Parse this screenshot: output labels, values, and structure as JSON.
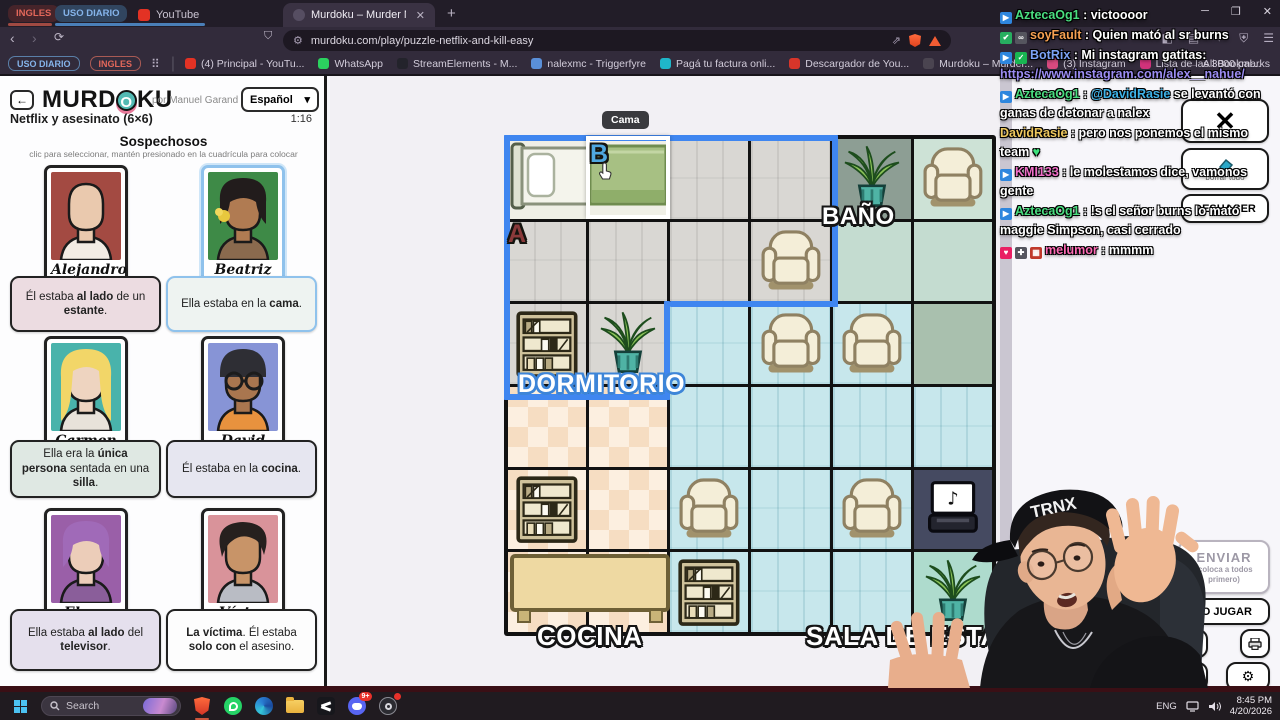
{
  "browser": {
    "tab_groups": [
      {
        "label": "INGLES"
      },
      {
        "label": "USO DIARIO"
      }
    ],
    "youtube_tab": "YouTube",
    "active_tab": "Murdoku – Murder Mystery mee",
    "close_glyph": "✕",
    "new_tab": "+",
    "url": "murdoku.com/play/puzzle-netflix-and-kill-easy",
    "bookmark_pills": [
      "USO DIARIO",
      "INGLES"
    ],
    "bookmarks": [
      {
        "label": "(4) Principal - YouTu...",
        "color": "#e33224"
      },
      {
        "label": "WhatsApp",
        "color": "#2bd25f"
      },
      {
        "label": "StreamElements - M...",
        "color": "#23232b"
      },
      {
        "label": "nalexmc - Triggerfyre",
        "color": "#5a8fd8"
      },
      {
        "label": "Pagá tu factura onli...",
        "color": "#1fb6c9"
      },
      {
        "label": "Descargador de You...",
        "color": "#d8352a"
      },
      {
        "label": "Murdoku – Murder...",
        "color": "#4a4450"
      },
      {
        "label": "(3) Instagram",
        "color": "#d84a7f"
      },
      {
        "label": "Lista de las 3000 pal...",
        "color": "#d0327a"
      }
    ],
    "all_bookmarks": "All Bookmarks",
    "window_controls": [
      "─",
      "❐",
      "✕"
    ]
  },
  "game": {
    "logo_pre": "MURD",
    "logo_o": "O",
    "logo_post": "KU",
    "back_glyph": "←",
    "byline": "por Manuel Garand",
    "language": "Español",
    "lang_chevron": "▾",
    "puzzle_title": "Netflix y asesinato (6×6)",
    "timer": "1:16",
    "suspects_heading": "Sospechosos",
    "suspects_hint": "clic para seleccionar, mantén presionado en la cuadrícula para colocar",
    "suspects": [
      {
        "name": "Alejandro",
        "selected": false,
        "avatar": {
          "bg": "#a34a42",
          "skin": "#eac9ae",
          "hair": "none",
          "hairColor": "#caa88e",
          "shirt": "#f2ece4",
          "accessory": "none"
        },
        "clue": [
          [
            "Él estaba ",
            0
          ],
          [
            "al lado",
            1
          ],
          [
            " de un ",
            0
          ],
          [
            "estante",
            1
          ],
          [
            ".",
            0
          ]
        ],
        "clue_bg": "#ecdce1"
      },
      {
        "name": "Beatriz",
        "selected": true,
        "avatar": {
          "bg": "#3e8a47",
          "skin": "#b07b52",
          "hair": "bob",
          "hairColor": "#221c1c",
          "shirt": "#8a6a4e",
          "accessory": "flower"
        },
        "clue": [
          [
            "Ella estaba en la ",
            0
          ],
          [
            "cama",
            1
          ],
          [
            ".",
            0
          ]
        ],
        "clue_bg": "#eef3f1"
      },
      {
        "name": "Carmen",
        "selected": false,
        "avatar": {
          "bg": "#49b3ab",
          "skin": "#eed4c0",
          "hair": "long",
          "hairColor": "#f2d668",
          "shirt": "#e8e2da",
          "accessory": "none"
        },
        "clue": [
          [
            "Ella era la ",
            0
          ],
          [
            "única persona",
            1
          ],
          [
            " sentada en una ",
            0
          ],
          [
            "silla",
            1
          ],
          [
            ".",
            0
          ]
        ],
        "clue_bg": "#dfe8e3"
      },
      {
        "name": "David",
        "selected": false,
        "avatar": {
          "bg": "#8794d6",
          "skin": "#a9764f",
          "hair": "beanie",
          "hairColor": "#2e2e34",
          "shirt": "#e8923e",
          "accessory": "glasses"
        },
        "clue": [
          [
            "Él estaba en la ",
            0
          ],
          [
            "cocina",
            1
          ],
          [
            ".",
            0
          ]
        ],
        "clue_bg": "#e6e6f0"
      },
      {
        "name": "Elena",
        "selected": false,
        "avatar": {
          "bg": "#9a5fa8",
          "skin": "#eccdb9",
          "hair": "bob",
          "hairColor": "#a06ab8",
          "shirt": "#8a5e9a",
          "accessory": "none"
        },
        "clue": [
          [
            "Ella estaba ",
            0
          ],
          [
            "al lado",
            1
          ],
          [
            " del ",
            0
          ],
          [
            "televisor",
            1
          ],
          [
            ".",
            0
          ]
        ],
        "clue_bg": "#e5e0ed"
      },
      {
        "name": "Víctor",
        "selected": false,
        "avatar": {
          "bg": "#d9939a",
          "skin": "#c89468",
          "hair": "messy",
          "hairColor": "#26201e",
          "shirt": "#b9bcc4",
          "accessory": "none"
        },
        "clue": [
          [
            "La víctima",
            1
          ],
          [
            ". Él estaba ",
            0
          ],
          [
            "solo con",
            1
          ],
          [
            " el asesino.",
            0
          ]
        ],
        "clue_bg": "#fdfdfd"
      }
    ],
    "grid": {
      "cells": [
        [
          "bed",
          "bed",
          "dorm",
          "dorm",
          "banoD:plant",
          "banoL:chair"
        ],
        [
          "dorm",
          "dorm",
          "dorm",
          "dorm:chair",
          "banoM",
          "banoM"
        ],
        [
          "dorm:shelf",
          "dorm:plant",
          "sala",
          "sala:chair",
          "sala:chair",
          "sage"
        ],
        [
          "cocina",
          "cocina",
          "sala",
          "sala",
          "sala",
          "sala"
        ],
        [
          "cocina:shelf",
          "cocina",
          "sala:chair",
          "sala",
          "sala:chair",
          "dark:laptop"
        ],
        [
          "cocina",
          "cocina",
          "sala:shelf",
          "sala",
          "sala",
          "teal:plant"
        ]
      ],
      "room_colors": {
        "bed": "#efefe6",
        "banoD": "#8d9e94",
        "banoL": "#cde2d6",
        "banoM": "#c4dcd0",
        "sage": "#a9c0ae",
        "dark": "#454a61",
        "teal": "#aedbcd"
      },
      "labels": [
        {
          "text": "BAÑO",
          "x": 492,
          "y": 127,
          "size": 24,
          "stroke": "st-black"
        },
        {
          "text": "DORMITORIO",
          "x": 188,
          "y": 294,
          "size": 25,
          "stroke": "st-blue"
        },
        {
          "text": "COCINA",
          "x": 207,
          "y": 545,
          "size": 26,
          "stroke": "st-black"
        },
        {
          "text": "SALA DE ESTAR",
          "x": 476,
          "y": 545,
          "size": 26,
          "stroke": "st-black"
        }
      ],
      "markers": [
        {
          "text": "B",
          "x": 260,
          "y": 64,
          "color": "#4fa8e0"
        },
        {
          "text": "A",
          "x": 178,
          "y": 144,
          "color": "#8a3a3a"
        }
      ],
      "tooltip": "Cama",
      "highlight_color": "#3f86f0"
    },
    "buttons": {
      "close": "✕",
      "erase_label": "borrar todo",
      "undo": "DESHACER",
      "submit": "ENVIAR",
      "submit_sub": "(coloca a todos primero)",
      "how_to_play": "CÓMO JUGAR",
      "gear": "⚙"
    }
  },
  "chat": {
    "messages": [
      {
        "badges": [
          {
            "bg": "#2e86de",
            "g": "▶"
          }
        ],
        "user": "AztecaOg1",
        "color": "#4ade80",
        "parts": [
          [
            "victoooor",
            ""
          ]
        ]
      },
      {
        "badges": [
          {
            "bg": "#27ae60",
            "g": "✔"
          },
          {
            "bg": "#55555e",
            "g": "∞"
          }
        ],
        "user": "soyFault",
        "color": "#f5a052",
        "parts": [
          [
            "Quien mató al sr burns",
            ""
          ]
        ]
      },
      {
        "badges": [
          {
            "bg": "#2e86de",
            "g": "▶"
          },
          {
            "bg": "#19b552",
            "g": "✓"
          }
        ],
        "user": "BotRix",
        "color": "#7ca2f5",
        "parts": [
          [
            "Mi instagram gatitas: ",
            ""
          ],
          [
            "https://www.instagram.com/alex__nahue/",
            "#9b8cf2"
          ]
        ]
      },
      {
        "badges": [
          {
            "bg": "#2e86de",
            "g": "▶"
          }
        ],
        "user": "AztecaOg1",
        "color": "#4ade80",
        "parts": [
          [
            "@DavidRasie",
            "#3db2e8"
          ],
          [
            " se levantó con ganas de detonar a nalex",
            ""
          ]
        ]
      },
      {
        "badges": [],
        "user": "DavidRasie",
        "color": "#eec85e",
        "parts": [
          [
            "pero nos ponemos el mismo team ",
            ""
          ],
          [
            "♥",
            "#3ce17c"
          ]
        ]
      },
      {
        "badges": [
          {
            "bg": "#2e86de",
            "g": "▶"
          }
        ],
        "user": "KMI133",
        "color": "#f06ec8",
        "parts": [
          [
            "le molestamos dice, vamonos gente",
            ""
          ]
        ]
      },
      {
        "badges": [
          {
            "bg": "#2e86de",
            "g": "▶"
          }
        ],
        "user": "AztecaOg1",
        "color": "#4ade80",
        "parts": [
          [
            "!s el señor burns lo mató maggie Simpson, casi cerrado",
            ""
          ]
        ]
      },
      {
        "badges": [
          {
            "bg": "#e91e63",
            "g": "♥"
          },
          {
            "bg": "#55555e",
            "g": "✚"
          },
          {
            "bg": "#c0392b",
            "g": "▦"
          }
        ],
        "user": "melumor",
        "color": "#ff6bb5",
        "parts": [
          [
            "mmmm",
            ""
          ]
        ]
      }
    ]
  },
  "streamer": {
    "cap_text": "TRNX"
  },
  "taskbar": {
    "search_placeholder": "Search",
    "apps": [
      "brave",
      "whatsapp",
      "edge",
      "folder",
      "capcut",
      "discord",
      "obs"
    ],
    "discord_badge": "9+",
    "tray_lang": "ENG",
    "time": "8:45 PM",
    "date": "4/20/2026"
  }
}
